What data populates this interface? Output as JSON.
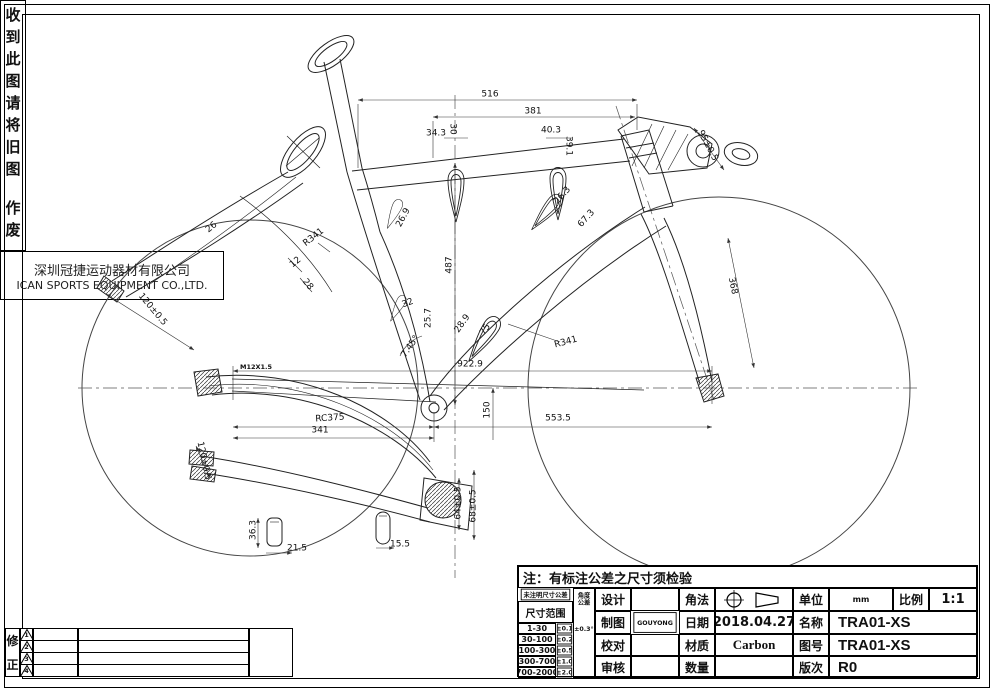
{
  "sheet": {
    "note": "注：有标注公差之尺寸须检验",
    "right_strip_top": "收到此图请将旧图",
    "right_strip_bottom": "作废",
    "revision": {
      "label_top": "修",
      "label_bottom": "正",
      "markers": [
        "1",
        "2",
        "3",
        "4"
      ]
    },
    "company": {
      "cn": "深圳冠捷运动器材有限公司",
      "en": "ICAN SPORTS EQUIPMENT CO.,LTD."
    }
  },
  "title_block": {
    "tolerance_table": {
      "header": "未注明尺寸公差",
      "subheader": "尺寸范围",
      "rows": [
        {
          "range": "1-30",
          "tol": "±0.1"
        },
        {
          "range": "30-100",
          "tol": "±0.2"
        },
        {
          "range": "100-300",
          "tol": "±0.5"
        },
        {
          "range": "300-700",
          "tol": "±1.0"
        },
        {
          "range": "700-2000",
          "tol": "±2.0"
        }
      ],
      "angle_header": "角度公差",
      "angle_tol": "±0.3°"
    },
    "fields": {
      "design_label": "设计",
      "design_value": "",
      "draft_label": "制图",
      "draft_value": "GOUYONG",
      "check_label": "校对",
      "check_value": "",
      "audit_label": "审核",
      "audit_value": "",
      "method_label": "角法",
      "date_label": "日期",
      "date_value": "2018.04.27",
      "material_label": "材质",
      "material_value": "Carbon",
      "qty_label": "数量",
      "qty_value": "",
      "unit_label": "单位",
      "unit_value": "mm",
      "scale_label": "比例",
      "scale_value": "1:1",
      "name_label": "名称",
      "name_value": "TRA01-XS",
      "drawing_no_label": "图号",
      "drawing_no_value": "TRA01-XS",
      "rev_label": "版次",
      "rev_value": "R0"
    }
  },
  "drawing": {
    "dimensions": [
      {
        "label": "516",
        "x": 490,
        "y": 95,
        "r": 0
      },
      {
        "label": "381",
        "x": 533,
        "y": 112,
        "r": 0
      },
      {
        "label": "34.3",
        "x": 436,
        "y": 134,
        "r": 0
      },
      {
        "label": "30",
        "x": 452,
        "y": 129,
        "r": 90
      },
      {
        "label": "40.3",
        "x": 551,
        "y": 131,
        "r": 0
      },
      {
        "label": "39.1",
        "x": 568,
        "y": 146,
        "r": 90
      },
      {
        "label": "95±0.5",
        "x": 707,
        "y": 146,
        "r": 62
      },
      {
        "label": "26.9",
        "x": 404,
        "y": 218,
        "r": -62
      },
      {
        "label": "26.3",
        "x": 563,
        "y": 196,
        "r": -48
      },
      {
        "label": "67.3",
        "x": 587,
        "y": 219,
        "r": -48
      },
      {
        "label": "487",
        "x": 450,
        "y": 265,
        "r": -90
      },
      {
        "label": "R341",
        "x": 314,
        "y": 238,
        "r": -38
      },
      {
        "label": "26",
        "x": 212,
        "y": 228,
        "r": -38
      },
      {
        "label": "12",
        "x": 296,
        "y": 263,
        "r": -38
      },
      {
        "label": "28",
        "x": 307,
        "y": 285,
        "r": 52
      },
      {
        "label": "120±0.5",
        "x": 152,
        "y": 310,
        "r": 50
      },
      {
        "label": "32",
        "x": 408,
        "y": 304,
        "r": -20
      },
      {
        "label": "25.7",
        "x": 429,
        "y": 318,
        "r": -90
      },
      {
        "label": "28.9",
        "x": 463,
        "y": 324,
        "r": -55
      },
      {
        "label": "75",
        "x": 486,
        "y": 330,
        "r": -55
      },
      {
        "label": "7.45°",
        "x": 411,
        "y": 347,
        "r": -55
      },
      {
        "label": "R341",
        "x": 566,
        "y": 343,
        "r": -15
      },
      {
        "label": "922.9",
        "x": 470,
        "y": 365,
        "r": 0
      },
      {
        "label": "M12X1.5",
        "x": 256,
        "y": 367,
        "r": 0,
        "bold": true
      },
      {
        "label": "150",
        "x": 488,
        "y": 410,
        "r": -90
      },
      {
        "label": "RC375",
        "x": 330,
        "y": 419,
        "r": -4
      },
      {
        "label": "341",
        "x": 320,
        "y": 431,
        "r": 0
      },
      {
        "label": "553.5",
        "x": 558,
        "y": 419,
        "r": 0
      },
      {
        "label": "120±0.5",
        "x": 203,
        "y": 461,
        "r": 78
      },
      {
        "label": "36.3",
        "x": 254,
        "y": 530,
        "r": -90
      },
      {
        "label": "21.5",
        "x": 297,
        "y": 549,
        "r": 0
      },
      {
        "label": "15.5",
        "x": 400,
        "y": 545,
        "r": 0
      },
      {
        "label": "64±0.5",
        "x": 459,
        "y": 503,
        "r": -90
      },
      {
        "label": "68±0.5",
        "x": 474,
        "y": 506,
        "r": -90
      },
      {
        "label": "368",
        "x": 732,
        "y": 286,
        "r": 78
      }
    ]
  }
}
